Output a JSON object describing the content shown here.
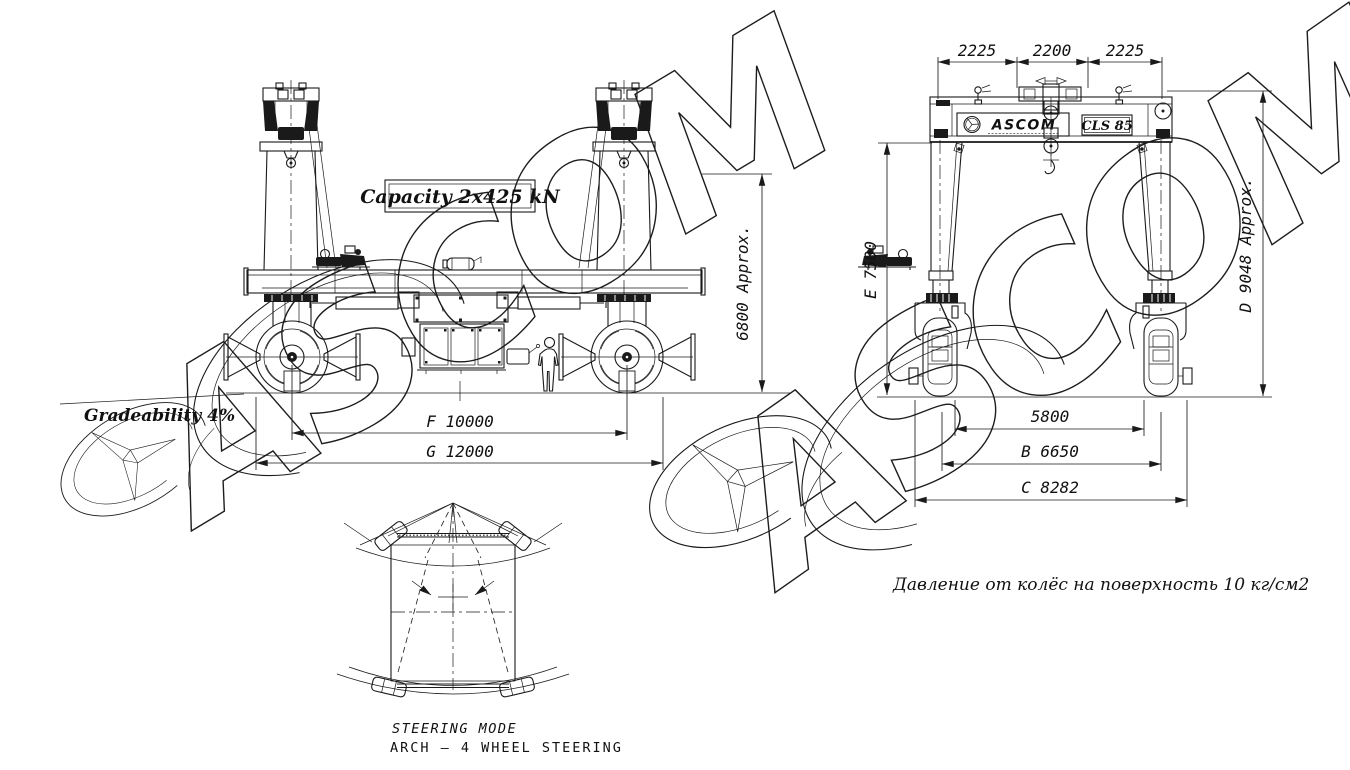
{
  "watermark": {
    "text": "ASCOM"
  },
  "side_view": {
    "capacity_label": "Capacity 2x425 kN",
    "gradeability_label": "Gradeability 4%",
    "dims": {
      "height": "6800 Approx.",
      "wheelbase": "F 10000",
      "length": "G 12000"
    }
  },
  "front_view": {
    "brand": "ASCOM",
    "model": "CLS 85",
    "dims": {
      "top_left": "2225",
      "top_center": "2200",
      "top_right": "2225",
      "clear_height": "E 7500",
      "overall_height": "D 9048 Approx.",
      "inner_span": "5800",
      "track": "B 6650",
      "overall_width": "C 8282"
    },
    "pressure_note": "Давление от колёс на поверхность 10 кг/см2"
  },
  "steering": {
    "title": "STEERING MODE",
    "mode": "ARCH – 4 WHEEL STEERING"
  }
}
